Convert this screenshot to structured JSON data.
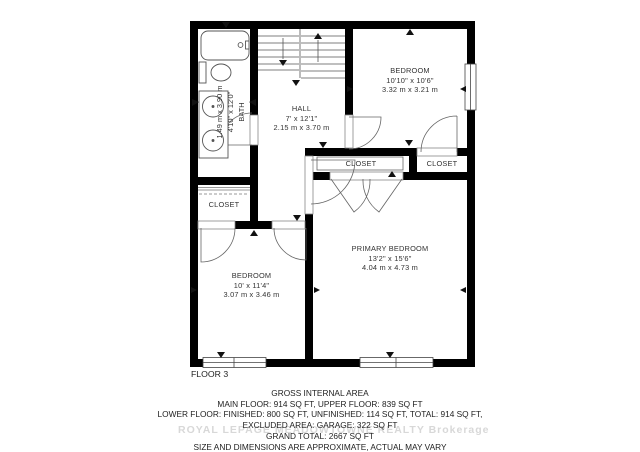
{
  "floor_label": "FLOOR 3",
  "rooms": {
    "bath": {
      "name": "BATH",
      "dims_ft": "4'10\" x 12'0\"",
      "dims_m": "1.49 m x 3.90 m"
    },
    "hall": {
      "name": "HALL",
      "dims_ft": "7' x 12'1\"",
      "dims_m": "2.15 m x 3.70 m"
    },
    "bedroom_top": {
      "name": "BEDROOM",
      "dims_ft": "10'10\" x 10'6\"",
      "dims_m": "3.32 m x 3.21 m"
    },
    "closet_left": {
      "name": "CLOSET"
    },
    "closet_mid": {
      "name": "CLOSET"
    },
    "closet_right": {
      "name": "CLOSET"
    },
    "primary_bedroom": {
      "name": "PRIMARY BEDROOM",
      "dims_ft": "13'2\" x 15'6\"",
      "dims_m": "4.04 m x 4.73 m"
    },
    "bedroom_left": {
      "name": "BEDROOM",
      "dims_ft": "10' x 11'4\"",
      "dims_m": "3.07 m x 3.46 m"
    }
  },
  "footer": {
    "title": "GROSS INTERNAL AREA",
    "line1": "MAIN FLOOR: 914 SQ FT, UPPER FLOOR: 839 SQ FT",
    "line2": "LOWER FLOOR: FINISHED: 800 SQ FT, UNFINISHED: 114 SQ FT, TOTAL: 914 SQ FT,",
    "line3": "EXCLUDED AREA: GARAGE: 322 SQ FT",
    "line4": "GRAND TOTAL: 2667 SQ FT",
    "disclaimer": "SIZE AND DIMENSIONS ARE APPROXIMATE, ACTUAL MAY VARY"
  },
  "watermark": "ROYAL LEPAGE MEADOWTOWNE REALTY Brokerage",
  "colors": {
    "walls": "#000000",
    "lines": "#555555",
    "text": "#222222",
    "watermark": "#d8d8d8"
  }
}
